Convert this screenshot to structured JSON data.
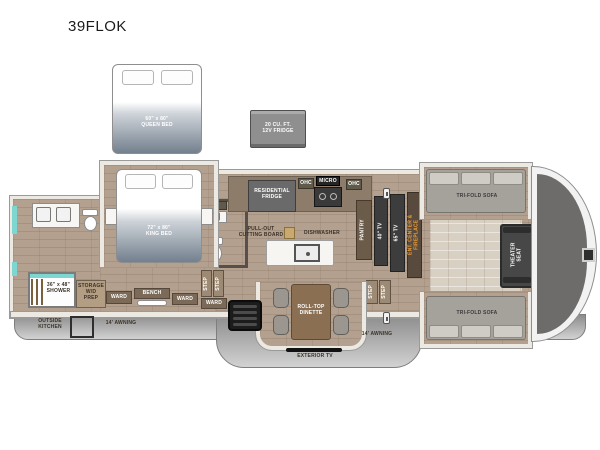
{
  "title": "39FLOK",
  "colors": {
    "floor": "#b3a08e",
    "teal_accent": "#7ed6d0",
    "ent_text": "#f0a13a",
    "skirt_gray": "#8c8c8c",
    "bed_gradient_bottom": "#73808e"
  },
  "options": {
    "queen_bed_size": "60\" x 80\"",
    "queen_bed_label": "QUEEN BED",
    "fridge_line1": "20 CU. FT.",
    "fridge_line2": "12V FRIDGE"
  },
  "bedroom": {
    "bed_size": "72\" x 80\"",
    "bed_label": "KING BED"
  },
  "bath": {
    "shower_size": "36\" x 48\"",
    "shower_label": "SHOWER",
    "ohc": "OHC"
  },
  "closet": {
    "storage_line1": "STORAGE",
    "storage_line2": "W/D",
    "storage_line3": "PREP",
    "ward1": "WARD",
    "bench": "BENCH",
    "ward2": "WARD",
    "ward3": "WARD"
  },
  "steps": {
    "step": "STEP"
  },
  "kitchen": {
    "fridge_line1": "RESIDENTIAL",
    "fridge_line2": "FRIDGE",
    "ohc_left": "OHC",
    "micro": "MICRO",
    "ohc_right": "OHC",
    "pullout_line1": "PULL-OUT",
    "pullout_line2": "CUTTING BOARD",
    "dishwasher": "DISHWASHER",
    "pantry": "PANTRY"
  },
  "entertainment": {
    "tv40": "40\" TV",
    "tv65": "65\" TV",
    "ent_line1": "ENT. CENTER &",
    "ent_line2": "FIREPLACE"
  },
  "living": {
    "sofa_top": "TRI-FOLD SOFA",
    "sofa_bottom": "TRI-FOLD SOFA",
    "theater_line1": "THEATER",
    "theater_line2": "SEAT",
    "ohc_top": "OHC",
    "ohc_bottom": "OHC"
  },
  "dinette": {
    "line1": "ROLL-TOP",
    "line2": "DINETTE"
  },
  "exterior": {
    "outside_kitchen_line1": "OUTSIDE",
    "outside_kitchen_line2": "KITCHEN",
    "awning_left": "14' AWNING",
    "awning_right": "14' AWNING",
    "exterior_tv": "EXTERIOR TV"
  }
}
